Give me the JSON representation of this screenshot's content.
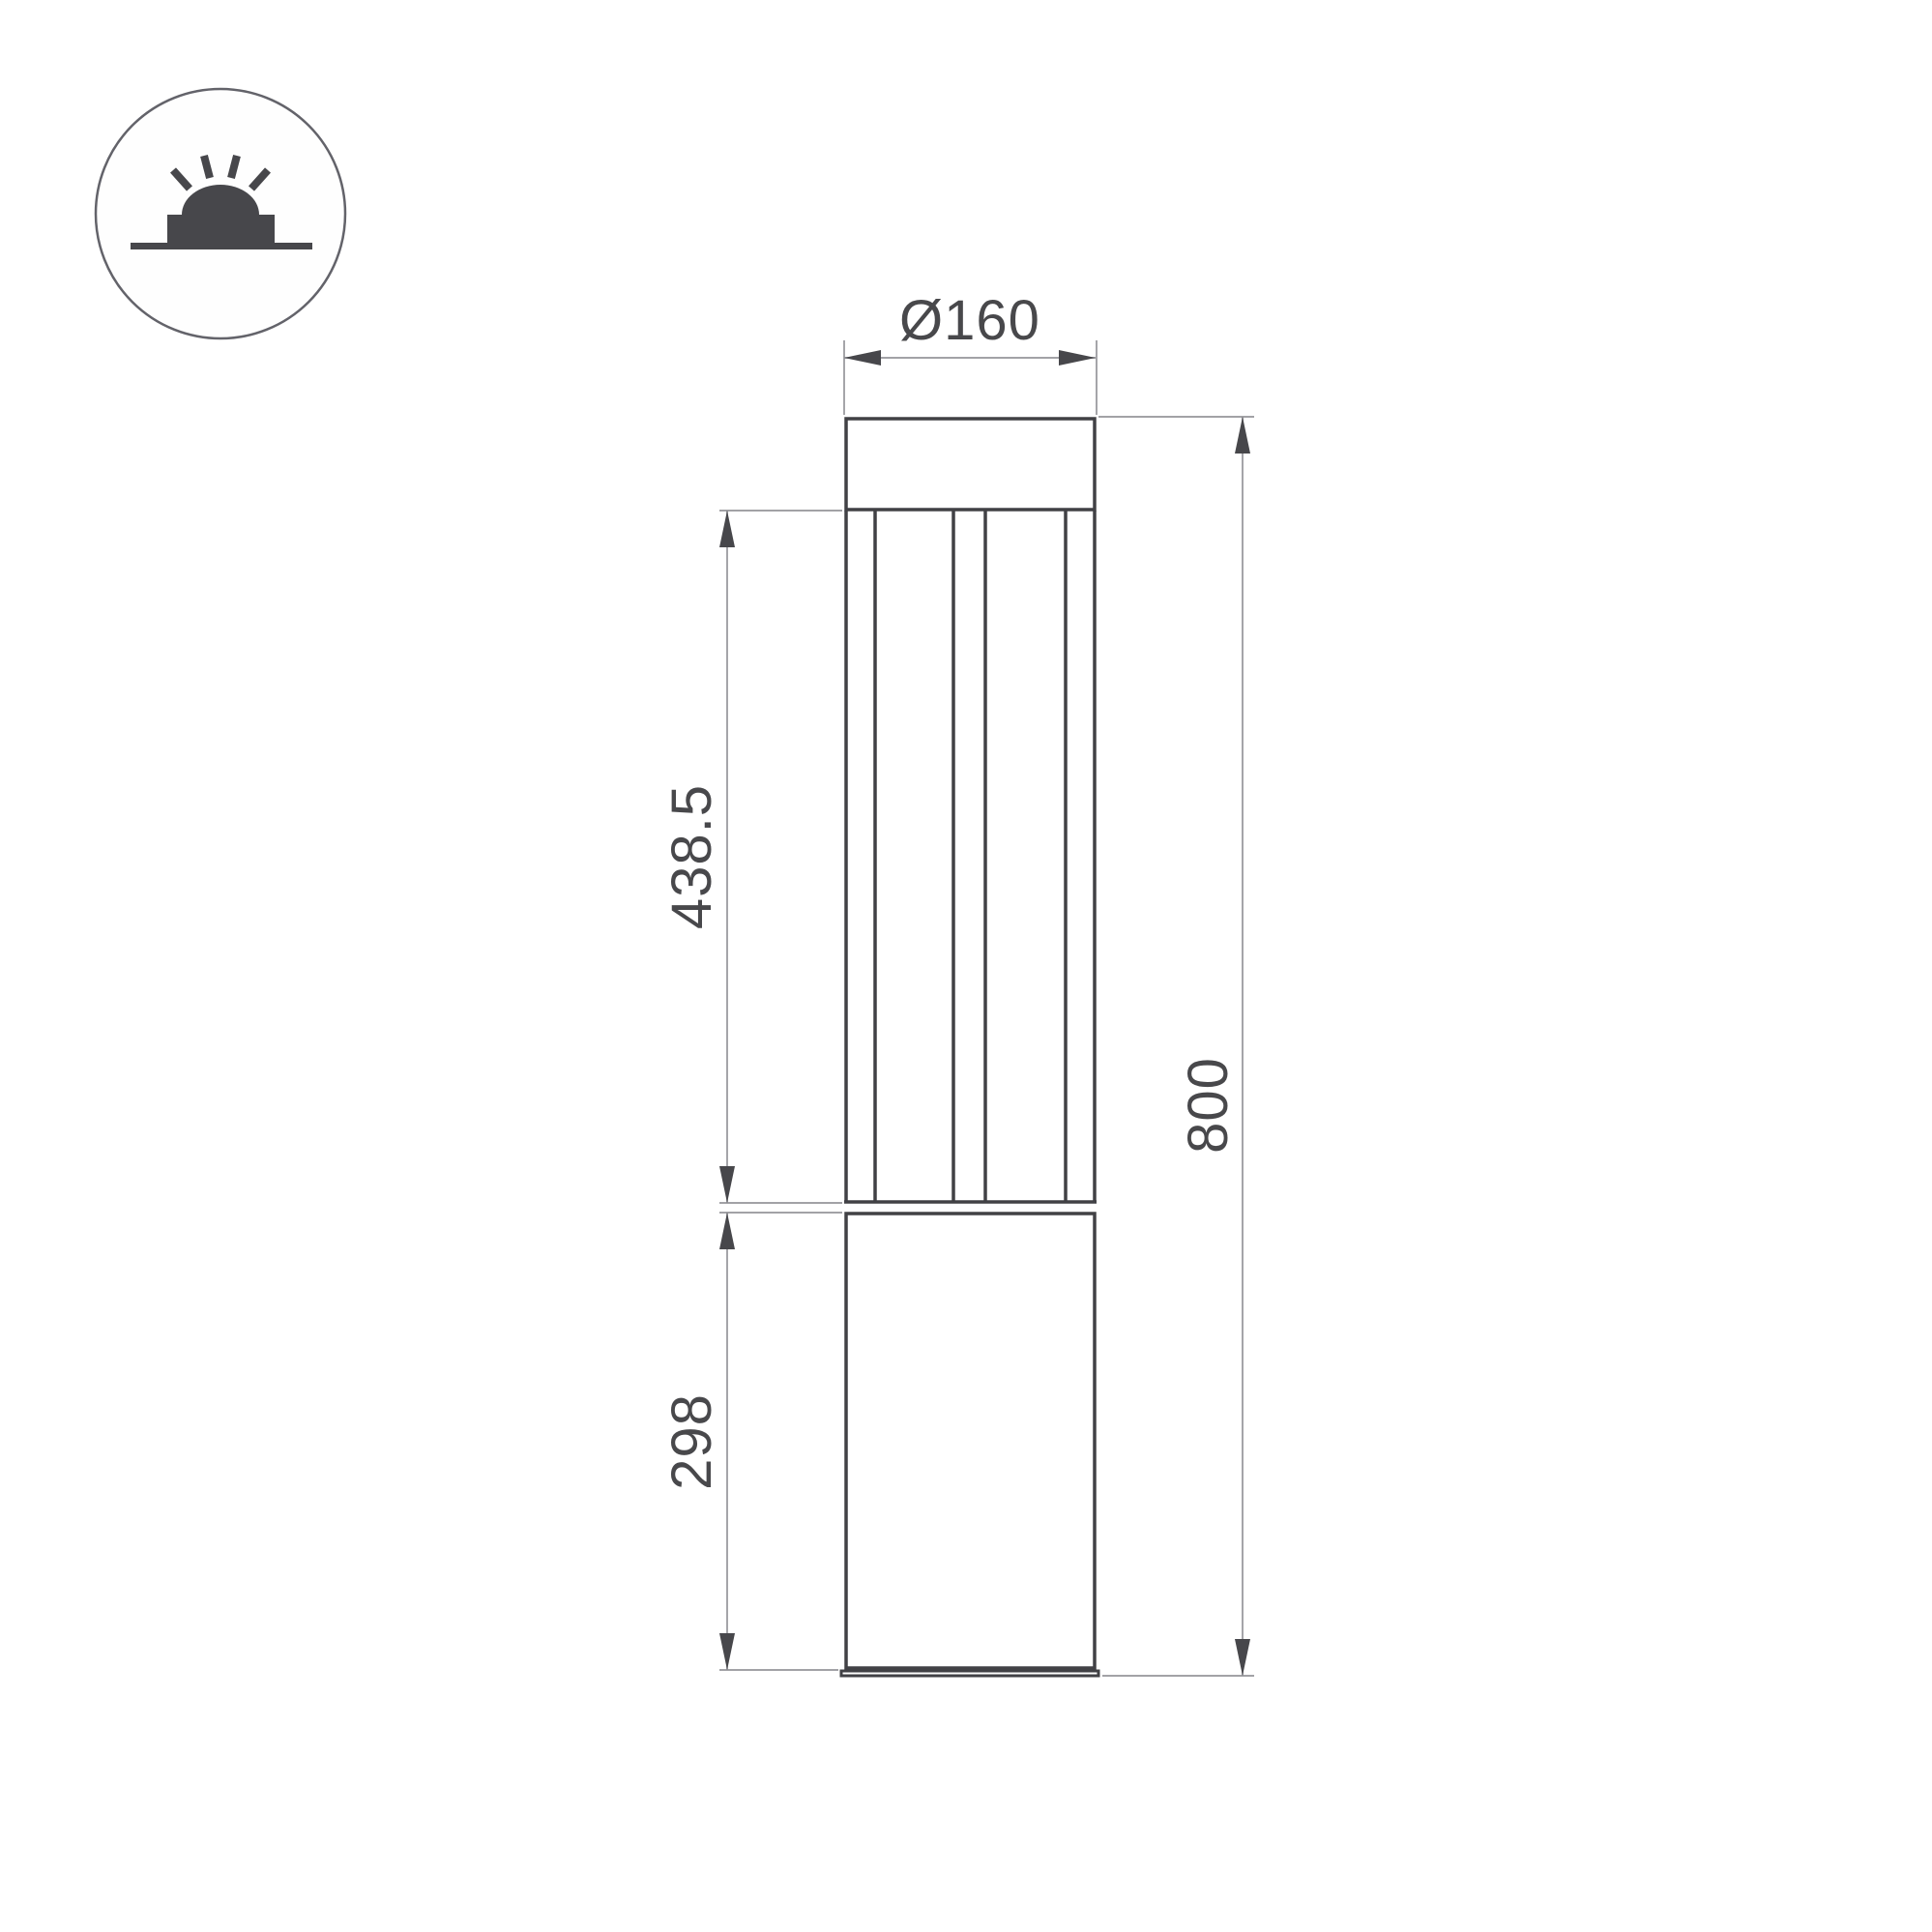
{
  "badge": {
    "icon": "surface-mounted-light-icon"
  },
  "drawing": {
    "dimensions": {
      "diameter": "Ø160",
      "lamp_section_height": "438.5",
      "total_height": "800",
      "base_section_height": "298"
    },
    "colors": {
      "outline": "#414145",
      "thin_line": "#95959a",
      "arrow": "#47474b",
      "text": "#48484b",
      "background": "#ffffff"
    }
  }
}
